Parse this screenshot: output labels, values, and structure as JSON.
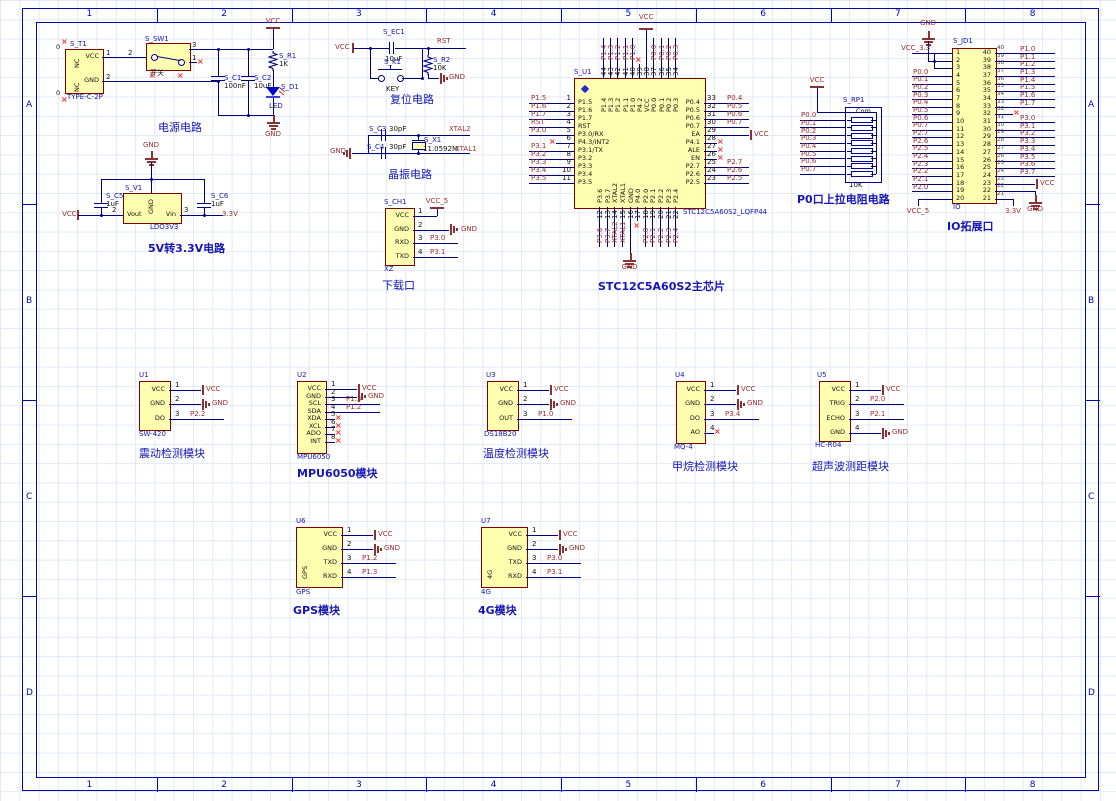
{
  "sheet": {
    "columns": [
      "1",
      "2",
      "3",
      "4",
      "5",
      "6",
      "7",
      "8"
    ],
    "rows": [
      "A",
      "B",
      "C",
      "D"
    ]
  },
  "colors": {
    "wire": "#00007F",
    "component_fill": "#FFFFB0",
    "component_border": "#800000",
    "net_label": "#9B2D2D",
    "designator": "#1515B5",
    "nc_marker": "#FF2A2A"
  },
  "power_circuit": {
    "title": "电源电路",
    "connector": {
      "designator": "S_T1",
      "part": "TYPE-C-2P",
      "left_pins": [
        "NC",
        "NC"
      ],
      "right_pins": [
        "VCC",
        "GND"
      ],
      "pin_numbers": [
        "1",
        "2"
      ],
      "nc_zero": "0"
    },
    "switch": {
      "designator": "S_SW1",
      "label": "开关",
      "pin_numbers": [
        "2",
        "3",
        "1"
      ]
    },
    "c1": {
      "designator": "S_C1",
      "value": "100nF"
    },
    "c2": {
      "designator": "S_C2",
      "value": "10uF"
    },
    "r1": {
      "designator": "S_R1",
      "value": "1K"
    },
    "d1": {
      "designator": "S_D1",
      "value": "LED"
    },
    "vcc": "VCC",
    "gnd": "GND"
  },
  "ldo_circuit": {
    "title": "5V转3.3V电路",
    "regulator": {
      "designator": "S_V1",
      "part": "LDO3V3",
      "pin_gnd": "GND",
      "pin_vout": "Vout",
      "pin_vin": "Vin",
      "num_vout": "2",
      "num_vin": "3"
    },
    "c5": {
      "designator": "S_C5",
      "value": "1uF"
    },
    "c6": {
      "designator": "S_C6",
      "value": "1uF"
    },
    "vcc": "VCC",
    "gnd": "GND",
    "v33": "3.3V"
  },
  "reset_circuit": {
    "title": "复位电路",
    "ec1": {
      "designator": "S_EC1",
      "value": "10uF"
    },
    "k1": {
      "designator": "S_K1",
      "label": "KEY"
    },
    "r2": {
      "designator": "S_R2",
      "value": "10K"
    },
    "vcc": "VCC",
    "rst": "RST",
    "gnd": "GND"
  },
  "crystal_circuit": {
    "title": "晶振电路",
    "c3": {
      "designator": "S_C3",
      "value": "30pF"
    },
    "c4": {
      "designator": "S_C4",
      "value": "30pF"
    },
    "x1": {
      "designator": "S_X1",
      "value": "11.0592M"
    },
    "xtal2": "XTAL2",
    "xtal1": "XTAL1",
    "gnd": "GND"
  },
  "download_port": {
    "title": "下载口",
    "designator": "S_CH1",
    "part": "XZ",
    "pins": [
      {
        "num": "1",
        "name": "VCC",
        "net": "VCC_5",
        "net_type": "vcc_up"
      },
      {
        "num": "2",
        "name": "GND",
        "net": "GND",
        "net_type": "gnd"
      },
      {
        "num": "3",
        "name": "RXD",
        "net": "P3.0",
        "net_type": "label"
      },
      {
        "num": "4",
        "name": "TXD",
        "net": "P3.1",
        "net_type": "label"
      }
    ]
  },
  "mcu": {
    "title": "STC12C5A60S2主芯片",
    "designator": "S_U1",
    "part": "STC12C5A60S2_LQFP44",
    "left_pins": [
      {
        "num": "1",
        "name": "P1.5",
        "net": "P1.5"
      },
      {
        "num": "2",
        "name": "P1.6",
        "net": "P1.6"
      },
      {
        "num": "3",
        "name": "P1.7",
        "net": "P1.7"
      },
      {
        "num": "4",
        "name": "RST",
        "net": "RST"
      },
      {
        "num": "5",
        "name": "P3.0/RX",
        "net": "P3.0"
      },
      {
        "num": "6",
        "name": "P4.3/INT2",
        "net": ""
      },
      {
        "num": "7",
        "name": "P3.1/TX",
        "net": "P3.1"
      },
      {
        "num": "8",
        "name": "P3.2",
        "net": "P3.2"
      },
      {
        "num": "9",
        "name": "P3.3",
        "net": "P3.3"
      },
      {
        "num": "10",
        "name": "P3.4",
        "net": "P3.4"
      },
      {
        "num": "11",
        "name": "P3.5",
        "net": "P3.5"
      }
    ],
    "right_pins": [
      {
        "num": "33",
        "name": "P0.4",
        "net": "P0.4"
      },
      {
        "num": "32",
        "name": "P0.5",
        "net": "P0.5"
      },
      {
        "num": "31",
        "name": "P0.6",
        "net": "P0.6"
      },
      {
        "num": "30",
        "name": "P0.7",
        "net": "P0.7"
      },
      {
        "num": "29",
        "name": "EA",
        "net": "VCC",
        "power": true
      },
      {
        "num": "28",
        "name": "P4.1",
        "net": ""
      },
      {
        "num": "27",
        "name": "ALE",
        "net": ""
      },
      {
        "num": "26",
        "name": "EN",
        "net": ""
      },
      {
        "num": "25",
        "name": "P2.7",
        "net": "P2.7"
      },
      {
        "num": "24",
        "name": "P2.6",
        "net": "P2.6"
      },
      {
        "num": "23",
        "name": "P2.5",
        "net": "P2.5"
      }
    ],
    "top_pins": [
      {
        "num": "44",
        "name": "P1.4",
        "net": "P1.4"
      },
      {
        "num": "43",
        "name": "P1.3",
        "net": "P1.3"
      },
      {
        "num": "42",
        "name": "P1.2",
        "net": "P1.2"
      },
      {
        "num": "41",
        "name": "P1.1",
        "net": "P1.1"
      },
      {
        "num": "40",
        "name": "P1.0",
        "net": "P1.0"
      },
      {
        "num": "39",
        "name": "P4.2",
        "net": ""
      },
      {
        "num": "38",
        "name": "VCC",
        "net": "VCC",
        "power": true
      },
      {
        "num": "37",
        "name": "P0.0",
        "net": "P0.0"
      },
      {
        "num": "36",
        "name": "P0.1",
        "net": "P0.1"
      },
      {
        "num": "35",
        "name": "P0.2",
        "net": "P0.2"
      },
      {
        "num": "34",
        "name": "P0.3",
        "net": "P0.3"
      }
    ],
    "bottom_pins": [
      {
        "num": "12",
        "name": "P3.6",
        "net": "P3.6"
      },
      {
        "num": "13",
        "name": "P3.7",
        "net": "P3.7"
      },
      {
        "num": "14",
        "name": "XTAL2",
        "net": "XTAL2"
      },
      {
        "num": "15",
        "name": "XTAL1",
        "net": "XTAL1"
      },
      {
        "num": "16",
        "name": "GND",
        "net": "GND",
        "power": true
      },
      {
        "num": "17",
        "name": "P4.0",
        "net": ""
      },
      {
        "num": "18",
        "name": "P2.0",
        "net": "P2.0"
      },
      {
        "num": "19",
        "name": "P2.1",
        "net": "P2.1"
      },
      {
        "num": "20",
        "name": "P2.2",
        "net": "P2.2"
      },
      {
        "num": "21",
        "name": "P2.3",
        "net": "P2.3"
      },
      {
        "num": "22",
        "name": "P2.4",
        "net": "P2.4"
      }
    ]
  },
  "pullup_circuit": {
    "title": "P0口上拉电阻电路",
    "designator": "S_RP1",
    "value": "10K",
    "com": "Com",
    "vcc": "VCC",
    "nets": [
      "P0.0",
      "P0.1",
      "P0.2",
      "P0.3",
      "P0.4",
      "P0.5",
      "P0.6",
      "P0.7"
    ]
  },
  "io_port": {
    "title": "IO拓展口",
    "designator": "S_JD1",
    "part": "IO",
    "gnd_top": "GND",
    "vcc_33": "VCC_3.3",
    "vcc_5": "VCC_5",
    "v33_bottom": "3.3V",
    "vcc_right": "VCC",
    "gnd_right": "GND",
    "left_numbers": [
      "1",
      "2",
      "3",
      "4",
      "5",
      "6",
      "7",
      "8",
      "9",
      "10",
      "11",
      "12",
      "13",
      "14",
      "15",
      "16",
      "17",
      "18",
      "19",
      "20"
    ],
    "right_numbers": [
      "40",
      "39",
      "38",
      "37",
      "36",
      "35",
      "34",
      "33",
      "32",
      "31",
      "30",
      "29",
      "28",
      "27",
      "26",
      "25",
      "24",
      "23",
      "22",
      "21"
    ],
    "left_nets": [
      "",
      "",
      "",
      "P0.0",
      "P0.1",
      "P0.2",
      "P0.3",
      "P0.4",
      "P0.5",
      "P0.6",
      "P0.7",
      "P2.7",
      "P2.6",
      "P2.5",
      "P2.4",
      "P2.3",
      "P2.2",
      "P2.1",
      "P2.0",
      ""
    ],
    "right_nets": [
      "P1.0",
      "P1.1",
      "P1.2",
      "P1.3",
      "P1.4",
      "P1.5",
      "P1.6",
      "P1.7",
      "",
      "P3.0",
      "P3.1",
      "P3.2",
      "P3.3",
      "P3.4",
      "P3.5",
      "P3.6",
      "P3.7",
      "",
      "",
      ""
    ]
  },
  "modules": [
    {
      "id": "u1",
      "designator": "U1",
      "part": "SW-420",
      "title": "震动检测模块",
      "bold": false,
      "pins": [
        {
          "num": "1",
          "name": "VCC",
          "net": "VCC",
          "type": "vcc"
        },
        {
          "num": "2",
          "name": "GND",
          "net": "GND",
          "type": "gnd"
        },
        {
          "num": "3",
          "name": "DO",
          "net": "P2.2",
          "type": "label"
        }
      ]
    },
    {
      "id": "u2",
      "designator": "U2",
      "part": "MPU6050",
      "title": "MPU6050模块",
      "bold": true,
      "pins": [
        {
          "num": "1",
          "name": "VCC",
          "net": "VCC",
          "type": "vcc"
        },
        {
          "num": "2",
          "name": "GND",
          "net": "GND",
          "type": "gnd"
        },
        {
          "num": "3",
          "name": "SCL",
          "net": "P1.3",
          "type": "label"
        },
        {
          "num": "4",
          "name": "SDA",
          "net": "P1.2",
          "type": "label"
        },
        {
          "num": "5",
          "name": "XDA",
          "net": "",
          "type": "nc"
        },
        {
          "num": "6",
          "name": "XCL",
          "net": "",
          "type": "nc"
        },
        {
          "num": "7",
          "name": "ADO",
          "net": "",
          "type": "nc"
        },
        {
          "num": "8",
          "name": "INT",
          "net": "",
          "type": "nc"
        }
      ]
    },
    {
      "id": "u3",
      "designator": "U3",
      "part": "DS18B20",
      "title": "温度检测模块",
      "bold": false,
      "pins": [
        {
          "num": "1",
          "name": "VCC",
          "net": "VCC",
          "type": "vcc"
        },
        {
          "num": "2",
          "name": "GND",
          "net": "GND",
          "type": "gnd"
        },
        {
          "num": "3",
          "name": "OUT",
          "net": "P1.0",
          "type": "label"
        }
      ]
    },
    {
      "id": "u4",
      "designator": "U4",
      "part": "MQ-4",
      "title": "甲烷检测模块",
      "bold": false,
      "pins": [
        {
          "num": "1",
          "name": "VCC",
          "net": "VCC",
          "type": "vcc"
        },
        {
          "num": "2",
          "name": "GND",
          "net": "GND",
          "type": "gnd"
        },
        {
          "num": "3",
          "name": "DO",
          "net": "P3.4",
          "type": "label"
        },
        {
          "num": "4",
          "name": "AO",
          "net": "",
          "type": "nc"
        }
      ]
    },
    {
      "id": "u5",
      "designator": "U5",
      "part": "HC-R04",
      "title": "超声波测距模块",
      "bold": false,
      "pins": [
        {
          "num": "1",
          "name": "VCC",
          "net": "VCC",
          "type": "vcc"
        },
        {
          "num": "2",
          "name": "TRIG",
          "net": "P2.0",
          "type": "label"
        },
        {
          "num": "3",
          "name": "ECHO",
          "net": "P2.1",
          "type": "label"
        },
        {
          "num": "4",
          "name": "GND",
          "net": "GND",
          "type": "gnd"
        }
      ]
    },
    {
      "id": "u6",
      "designator": "U6",
      "part": "GPS",
      "title": "GPS模块",
      "bold": true,
      "side_label": "GPS",
      "pins": [
        {
          "num": "1",
          "name": "VCC",
          "net": "VCC",
          "type": "vcc"
        },
        {
          "num": "2",
          "name": "GND",
          "net": "GND",
          "type": "gnd"
        },
        {
          "num": "3",
          "name": "TXD",
          "net": "P1.2",
          "type": "label"
        },
        {
          "num": "4",
          "name": "RXD",
          "net": "P1.3",
          "type": "label"
        }
      ]
    },
    {
      "id": "u7",
      "designator": "U7",
      "part": "4G",
      "title": "4G模块",
      "bold": true,
      "side_label": "4G",
      "pins": [
        {
          "num": "1",
          "name": "VCC",
          "net": "VCC",
          "type": "vcc"
        },
        {
          "num": "2",
          "name": "GND",
          "net": "GND",
          "type": "gnd"
        },
        {
          "num": "3",
          "name": "TXD",
          "net": "P3.0",
          "type": "label"
        },
        {
          "num": "4",
          "name": "RXD",
          "net": "P3.1",
          "type": "label"
        }
      ]
    }
  ]
}
